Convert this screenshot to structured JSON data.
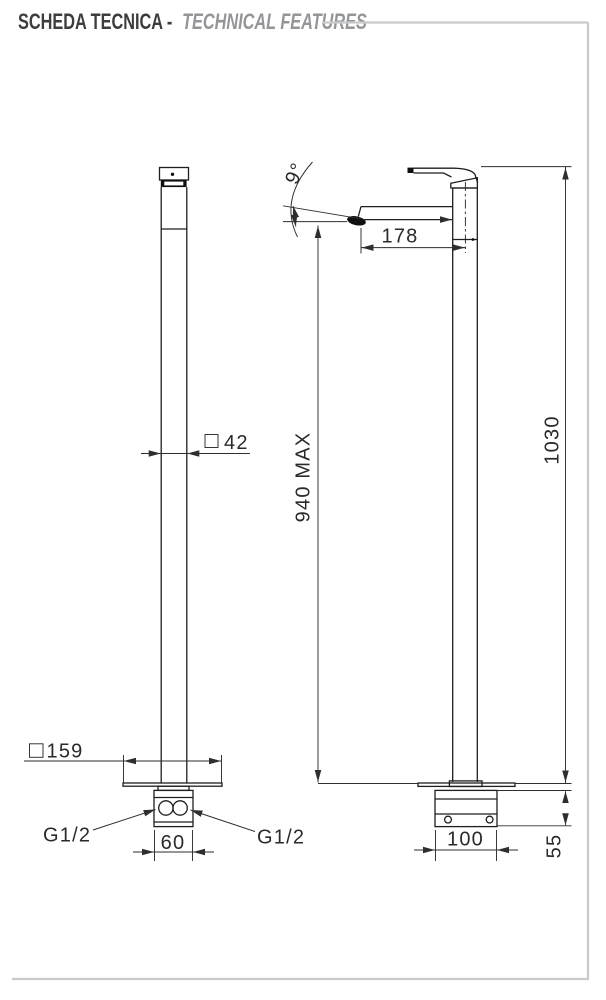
{
  "header": {
    "title_it": "SCHEDA TECNICA - ",
    "title_en": "TECHNICAL FEATURES"
  },
  "drawing": {
    "front_view": {
      "body_square_width": "42",
      "floor_plate_width": "159",
      "inlet_left": "G1/2",
      "inlet_right": "G1/2",
      "inlet_spacing": "60"
    },
    "side_view": {
      "spout_angle": "9°",
      "spout_reach": "178",
      "spout_height_max": "940 MAX",
      "total_height": "1030",
      "base_depth": "100",
      "base_height": "55"
    }
  }
}
